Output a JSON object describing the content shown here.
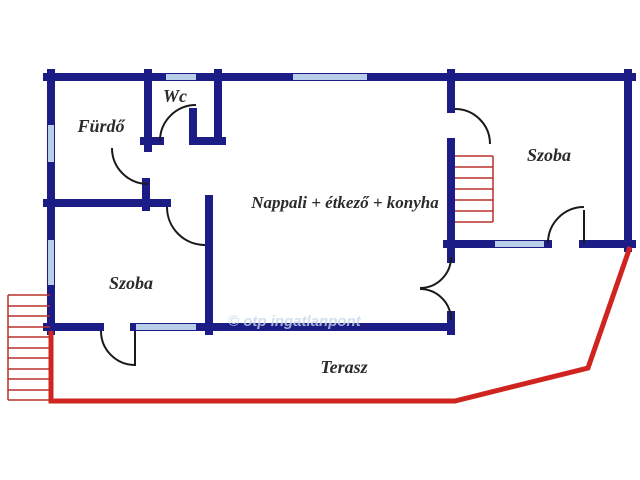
{
  "title": "Alaprajz (floor plan)",
  "colors": {
    "wall": "#1c1c87",
    "window": "#b9cfe9",
    "terrace": "#d02421",
    "stairs": "#b73229",
    "door": "#1a1a1a",
    "label": "#2b2b2b",
    "watermark": "#c8d8ec"
  },
  "rooms": {
    "furdo": "Fürdő",
    "wc": "Wc",
    "nappali": "Nappali + étkező + konyha",
    "szoba_right": "Szoba",
    "szoba_left": "Szoba",
    "terasz": "Terasz"
  },
  "watermark_text": "© otp ingatlanpont"
}
